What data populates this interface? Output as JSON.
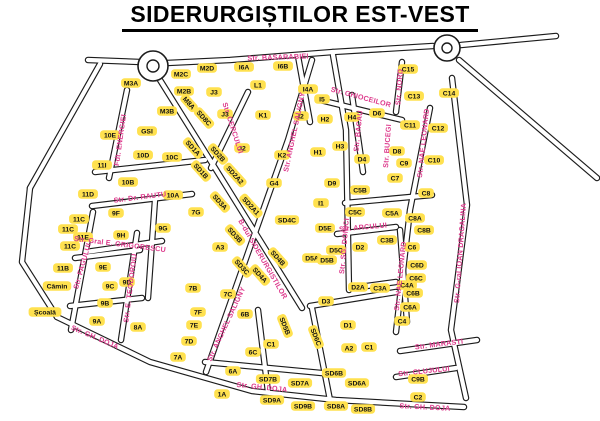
{
  "title": "SIDERURGIȘTILOR EST-VEST",
  "colors": {
    "background": "#ffffff",
    "road_casing": "#1c1c1c",
    "road_fill": "#ffffff",
    "block_fill": "#ffe14f",
    "block_text": "#111111",
    "street_label": "#dd3a8c",
    "facility_text": "#111111",
    "title_color": "#000000"
  },
  "map": {
    "width": 600,
    "height": 421,
    "roundabouts": [
      {
        "cx": 153,
        "cy": 66,
        "r": 15,
        "inner_r": 6
      },
      {
        "cx": 447,
        "cy": 48,
        "r": 13,
        "inner_r": 5
      }
    ],
    "roads": [
      [
        [
          88,
          60
        ],
        [
          140,
          62
        ]
      ],
      [
        [
          167,
          63
        ],
        [
          230,
          60
        ],
        [
          333,
          52
        ]
      ],
      [
        [
          333,
          52
        ],
        [
          433,
          46
        ]
      ],
      [
        [
          461,
          45
        ],
        [
          556,
          36
        ]
      ],
      [
        [
          459,
          60
        ],
        [
          597,
          178
        ]
      ],
      [
        [
          452,
          78
        ],
        [
          467,
          205
        ],
        [
          451,
          330
        ],
        [
          466,
          398
        ]
      ],
      [
        [
          100,
          64
        ],
        [
          30,
          188
        ]
      ],
      [
        [
          30,
          188
        ],
        [
          22,
          262
        ],
        [
          57,
          317
        ]
      ],
      [
        [
          57,
          317
        ],
        [
          150,
          362
        ],
        [
          252,
          391
        ],
        [
          336,
          400
        ],
        [
          464,
          407
        ]
      ],
      [
        [
          312,
          60
        ],
        [
          288,
          140
        ],
        [
          249,
          250
        ],
        [
          206,
          372
        ]
      ],
      [
        [
          160,
          80
        ],
        [
          215,
          168
        ],
        [
          302,
          308
        ]
      ],
      [
        [
          248,
          92
        ],
        [
          211,
          168
        ]
      ],
      [
        [
          333,
          55
        ],
        [
          346,
          130
        ],
        [
          349,
          290
        ]
      ],
      [
        [
          352,
          95
        ],
        [
          363,
          172
        ]
      ],
      [
        [
          402,
          62
        ],
        [
          396,
          112
        ]
      ],
      [
        [
          320,
          100
        ],
        [
          402,
          120
        ]
      ],
      [
        [
          430,
          108
        ],
        [
          410,
          210
        ],
        [
          396,
          332
        ]
      ],
      [
        [
          127,
          90
        ],
        [
          109,
          178
        ]
      ],
      [
        [
          92,
          206
        ],
        [
          192,
          194
        ]
      ],
      [
        [
          93,
          212
        ],
        [
          71,
          330
        ]
      ],
      [
        [
          137,
          233
        ],
        [
          121,
          340
        ]
      ],
      [
        [
          86,
          252
        ],
        [
          162,
          241
        ]
      ],
      [
        [
          337,
          234
        ],
        [
          396,
          227
        ]
      ],
      [
        [
          400,
          351
        ],
        [
          477,
          340
        ]
      ],
      [
        [
          396,
          377
        ],
        [
          456,
          368
        ]
      ],
      [
        [
          95,
          172
        ],
        [
          205,
          160
        ]
      ],
      [
        [
          298,
          56
        ],
        [
          310,
          122
        ]
      ],
      [
        [
          258,
          310
        ],
        [
          268,
          392
        ]
      ],
      [
        [
          205,
          362
        ],
        [
          332,
          374
        ]
      ],
      [
        [
          400,
          230
        ],
        [
          407,
          322
        ]
      ],
      [
        [
          312,
          308
        ],
        [
          330,
          400
        ]
      ],
      [
        [
          310,
          306
        ],
        [
          396,
          292
        ]
      ],
      [
        [
          155,
          200
        ],
        [
          148,
          298
        ]
      ],
      [
        [
          75,
          258
        ],
        [
          140,
          250
        ]
      ],
      [
        [
          70,
          306
        ],
        [
          142,
          298
        ]
      ],
      [
        [
          345,
          203
        ],
        [
          432,
          195
        ]
      ],
      [
        [
          352,
          288
        ],
        [
          396,
          282
        ]
      ]
    ],
    "streets": [
      {
        "label": "Str. BASARABIEI",
        "x": 278,
        "y": 57,
        "rotate": -2
      },
      {
        "label": "Fdt. ENERGIEI",
        "x": 120,
        "y": 140,
        "rotate": -82
      },
      {
        "label": "Str. CERCULUI",
        "x": 233,
        "y": 128,
        "rotate": 72
      },
      {
        "label": "Str. ANGHEL SALIGNY",
        "x": 294,
        "y": 132,
        "rotate": -78
      },
      {
        "label": "Str. ANGHEL SALIGNY",
        "x": 226,
        "y": 324,
        "rotate": -65
      },
      {
        "label": "Str. GHIOCEILOR",
        "x": 361,
        "y": 97,
        "rotate": 15
      },
      {
        "label": "Str. NORD",
        "x": 399,
        "y": 87,
        "rotate": -86
      },
      {
        "label": "Str. BACAU",
        "x": 358,
        "y": 131,
        "rotate": -84
      },
      {
        "label": "Str. BUCEGI",
        "x": 387,
        "y": 146,
        "rotate": -86
      },
      {
        "label": "Str. NAE LEONARD",
        "x": 423,
        "y": 143,
        "rotate": -84
      },
      {
        "label": "Str. NAE LEONARD",
        "x": 400,
        "y": 276,
        "rotate": -84
      },
      {
        "label": "Str. G-ral IOAN DRAGALINA",
        "x": 460,
        "y": 253,
        "rotate": -86
      },
      {
        "label": "Str. Dr. RAUTU",
        "x": 140,
        "y": 197,
        "rotate": -7
      },
      {
        "label": "Str. FAGULUI",
        "x": 82,
        "y": 266,
        "rotate": -74
      },
      {
        "label": "Str. E. TEODOROIU",
        "x": 130,
        "y": 288,
        "rotate": -83
      },
      {
        "label": "Str. Gral E. GRIGORESCU",
        "x": 120,
        "y": 244,
        "rotate": 7
      },
      {
        "label": "B-dul SIDERURGISTILOR",
        "x": 263,
        "y": 259,
        "rotate": 60
      },
      {
        "label": "Str. ARCULUI",
        "x": 363,
        "y": 227,
        "rotate": -5
      },
      {
        "label": "Str. SG. DONICI",
        "x": 344,
        "y": 246,
        "rotate": -85
      },
      {
        "label": "Str. GH. DOJA",
        "x": 95,
        "y": 337,
        "rotate": 23
      },
      {
        "label": "Str. GH. DOJA",
        "x": 262,
        "y": 387,
        "rotate": 6
      },
      {
        "label": "Str. GH. DOJA",
        "x": 425,
        "y": 407,
        "rotate": 3
      },
      {
        "label": "Str. MARASTI",
        "x": 439,
        "y": 344,
        "rotate": -7
      },
      {
        "label": "Str. CLUJULUI",
        "x": 424,
        "y": 371,
        "rotate": -6
      }
    ],
    "blocks": [
      {
        "label": "M3A",
        "x": 131,
        "y": 83
      },
      {
        "label": "M2C",
        "x": 181,
        "y": 74
      },
      {
        "label": "M2D",
        "x": 207,
        "y": 68
      },
      {
        "label": "M2B",
        "x": 184,
        "y": 91
      },
      {
        "label": "M3B",
        "x": 167,
        "y": 111
      },
      {
        "label": "M8A",
        "x": 189,
        "y": 103,
        "rotate": 48
      },
      {
        "label": "SD8C",
        "x": 204,
        "y": 118,
        "rotate": 48
      },
      {
        "label": "SD1A",
        "x": 193,
        "y": 148,
        "rotate": 48
      },
      {
        "label": "J3",
        "x": 214,
        "y": 92
      },
      {
        "label": "J3",
        "x": 225,
        "y": 114
      },
      {
        "label": "J2",
        "x": 242,
        "y": 148
      },
      {
        "label": "L1",
        "x": 258,
        "y": 85
      },
      {
        "label": "I6A",
        "x": 244,
        "y": 67
      },
      {
        "label": "I6B",
        "x": 283,
        "y": 66
      },
      {
        "label": "I4A",
        "x": 308,
        "y": 89
      },
      {
        "label": "K1",
        "x": 263,
        "y": 115
      },
      {
        "label": "I2",
        "x": 301,
        "y": 116
      },
      {
        "label": "K2",
        "x": 282,
        "y": 155
      },
      {
        "label": "I5",
        "x": 322,
        "y": 99
      },
      {
        "label": "H2",
        "x": 325,
        "y": 119
      },
      {
        "label": "H4",
        "x": 352,
        "y": 117
      },
      {
        "label": "H1",
        "x": 318,
        "y": 152
      },
      {
        "label": "H3",
        "x": 340,
        "y": 146
      },
      {
        "label": "D6",
        "x": 377,
        "y": 113
      },
      {
        "label": "D4",
        "x": 362,
        "y": 159
      },
      {
        "label": "D8",
        "x": 397,
        "y": 151
      },
      {
        "label": "D9",
        "x": 332,
        "y": 183
      },
      {
        "label": "C15",
        "x": 408,
        "y": 69
      },
      {
        "label": "C13",
        "x": 414,
        "y": 96
      },
      {
        "label": "C14",
        "x": 449,
        "y": 93
      },
      {
        "label": "C11",
        "x": 410,
        "y": 125
      },
      {
        "label": "C12",
        "x": 438,
        "y": 128
      },
      {
        "label": "C10",
        "x": 434,
        "y": 160
      },
      {
        "label": "C9",
        "x": 404,
        "y": 163
      },
      {
        "label": "C7",
        "x": 395,
        "y": 178
      },
      {
        "label": "C8",
        "x": 426,
        "y": 193
      },
      {
        "label": "C5B",
        "x": 360,
        "y": 190
      },
      {
        "label": "C5C",
        "x": 355,
        "y": 212
      },
      {
        "label": "C5A",
        "x": 392,
        "y": 213
      },
      {
        "label": "C8A",
        "x": 415,
        "y": 218
      },
      {
        "label": "C8B",
        "x": 424,
        "y": 230
      },
      {
        "label": "I1",
        "x": 321,
        "y": 203
      },
      {
        "label": "G4",
        "x": 274,
        "y": 183
      },
      {
        "label": "SD1B",
        "x": 201,
        "y": 171,
        "rotate": 48
      },
      {
        "label": "SD2B",
        "x": 218,
        "y": 154,
        "rotate": 48
      },
      {
        "label": "SD2A2",
        "x": 235,
        "y": 175,
        "rotate": 48
      },
      {
        "label": "SD2A1",
        "x": 251,
        "y": 206,
        "rotate": 48
      },
      {
        "label": "SD3A",
        "x": 220,
        "y": 202,
        "rotate": 48
      },
      {
        "label": "SD3B",
        "x": 235,
        "y": 235,
        "rotate": 48
      },
      {
        "label": "SD3C",
        "x": 242,
        "y": 267,
        "rotate": 48
      },
      {
        "label": "SD4A",
        "x": 260,
        "y": 275,
        "rotate": 48
      },
      {
        "label": "SD4B",
        "x": 278,
        "y": 258,
        "rotate": 48
      },
      {
        "label": "SD4C",
        "x": 287,
        "y": 220
      },
      {
        "label": "SD5B",
        "x": 285,
        "y": 326,
        "rotate": 68
      },
      {
        "label": "SD6C",
        "x": 316,
        "y": 337,
        "rotate": 68
      },
      {
        "label": "D5E",
        "x": 325,
        "y": 228
      },
      {
        "label": "D5C",
        "x": 336,
        "y": 250
      },
      {
        "label": "D5A",
        "x": 312,
        "y": 258
      },
      {
        "label": "D5B",
        "x": 327,
        "y": 260
      },
      {
        "label": "D2",
        "x": 360,
        "y": 247
      },
      {
        "label": "C3B",
        "x": 387,
        "y": 240
      },
      {
        "label": "C6",
        "x": 412,
        "y": 247
      },
      {
        "label": "C6D",
        "x": 417,
        "y": 265
      },
      {
        "label": "C6C",
        "x": 416,
        "y": 278
      },
      {
        "label": "C4A",
        "x": 407,
        "y": 285
      },
      {
        "label": "C3A",
        "x": 380,
        "y": 288
      },
      {
        "label": "D2A",
        "x": 358,
        "y": 287
      },
      {
        "label": "D3",
        "x": 326,
        "y": 301
      },
      {
        "label": "D1",
        "x": 348,
        "y": 325
      },
      {
        "label": "A2",
        "x": 349,
        "y": 348
      },
      {
        "label": "C1",
        "x": 369,
        "y": 347
      },
      {
        "label": "C4",
        "x": 402,
        "y": 321
      },
      {
        "label": "C6A",
        "x": 410,
        "y": 307
      },
      {
        "label": "C6B",
        "x": 413,
        "y": 293
      },
      {
        "label": "C9B",
        "x": 418,
        "y": 379
      },
      {
        "label": "C2",
        "x": 418,
        "y": 397
      },
      {
        "label": "SD6B",
        "x": 334,
        "y": 373
      },
      {
        "label": "SD6A",
        "x": 357,
        "y": 383
      },
      {
        "label": "SD8A",
        "x": 336,
        "y": 406
      },
      {
        "label": "SD8B",
        "x": 363,
        "y": 409
      },
      {
        "label": "SD7B",
        "x": 268,
        "y": 379
      },
      {
        "label": "SD7A",
        "x": 300,
        "y": 383
      },
      {
        "label": "SD9A",
        "x": 272,
        "y": 400
      },
      {
        "label": "SD9B",
        "x": 303,
        "y": 406
      },
      {
        "label": "6A",
        "x": 233,
        "y": 371
      },
      {
        "label": "6B",
        "x": 245,
        "y": 314
      },
      {
        "label": "6C",
        "x": 253,
        "y": 352
      },
      {
        "label": "C1",
        "x": 271,
        "y": 344
      },
      {
        "label": "1A",
        "x": 222,
        "y": 394
      },
      {
        "label": "7A",
        "x": 178,
        "y": 357
      },
      {
        "label": "7B",
        "x": 193,
        "y": 288
      },
      {
        "label": "7C",
        "x": 228,
        "y": 294
      },
      {
        "label": "7D",
        "x": 189,
        "y": 341
      },
      {
        "label": "7E",
        "x": 194,
        "y": 325
      },
      {
        "label": "7F",
        "x": 198,
        "y": 312
      },
      {
        "label": "7G",
        "x": 196,
        "y": 212
      },
      {
        "label": "8A",
        "x": 138,
        "y": 327
      },
      {
        "label": "9A",
        "x": 97,
        "y": 321
      },
      {
        "label": "9B",
        "x": 105,
        "y": 303
      },
      {
        "label": "9C",
        "x": 110,
        "y": 286
      },
      {
        "label": "9D",
        "x": 127,
        "y": 282
      },
      {
        "label": "9E",
        "x": 103,
        "y": 267
      },
      {
        "label": "9F",
        "x": 116,
        "y": 213
      },
      {
        "label": "9G",
        "x": 163,
        "y": 228
      },
      {
        "label": "9H",
        "x": 121,
        "y": 235
      },
      {
        "label": "10A",
        "x": 173,
        "y": 195
      },
      {
        "label": "10B",
        "x": 128,
        "y": 182
      },
      {
        "label": "10C",
        "x": 172,
        "y": 157
      },
      {
        "label": "10D",
        "x": 143,
        "y": 155
      },
      {
        "label": "10E",
        "x": 110,
        "y": 135
      },
      {
        "label": "GSI",
        "x": 147,
        "y": 131
      },
      {
        "label": "11B",
        "x": 63,
        "y": 268
      },
      {
        "label": "11C",
        "x": 79,
        "y": 219
      },
      {
        "label": "11C",
        "x": 68,
        "y": 229
      },
      {
        "label": "11C",
        "x": 70,
        "y": 246
      },
      {
        "label": "11D",
        "x": 88,
        "y": 194
      },
      {
        "label": "11E",
        "x": 83,
        "y": 237
      },
      {
        "label": "11I",
        "x": 102,
        "y": 165
      },
      {
        "label": "A3",
        "x": 220,
        "y": 247
      }
    ],
    "facilities": [
      {
        "label": "Cămin",
        "x": 57,
        "y": 286
      },
      {
        "label": "Școală",
        "x": 45,
        "y": 312
      }
    ]
  }
}
